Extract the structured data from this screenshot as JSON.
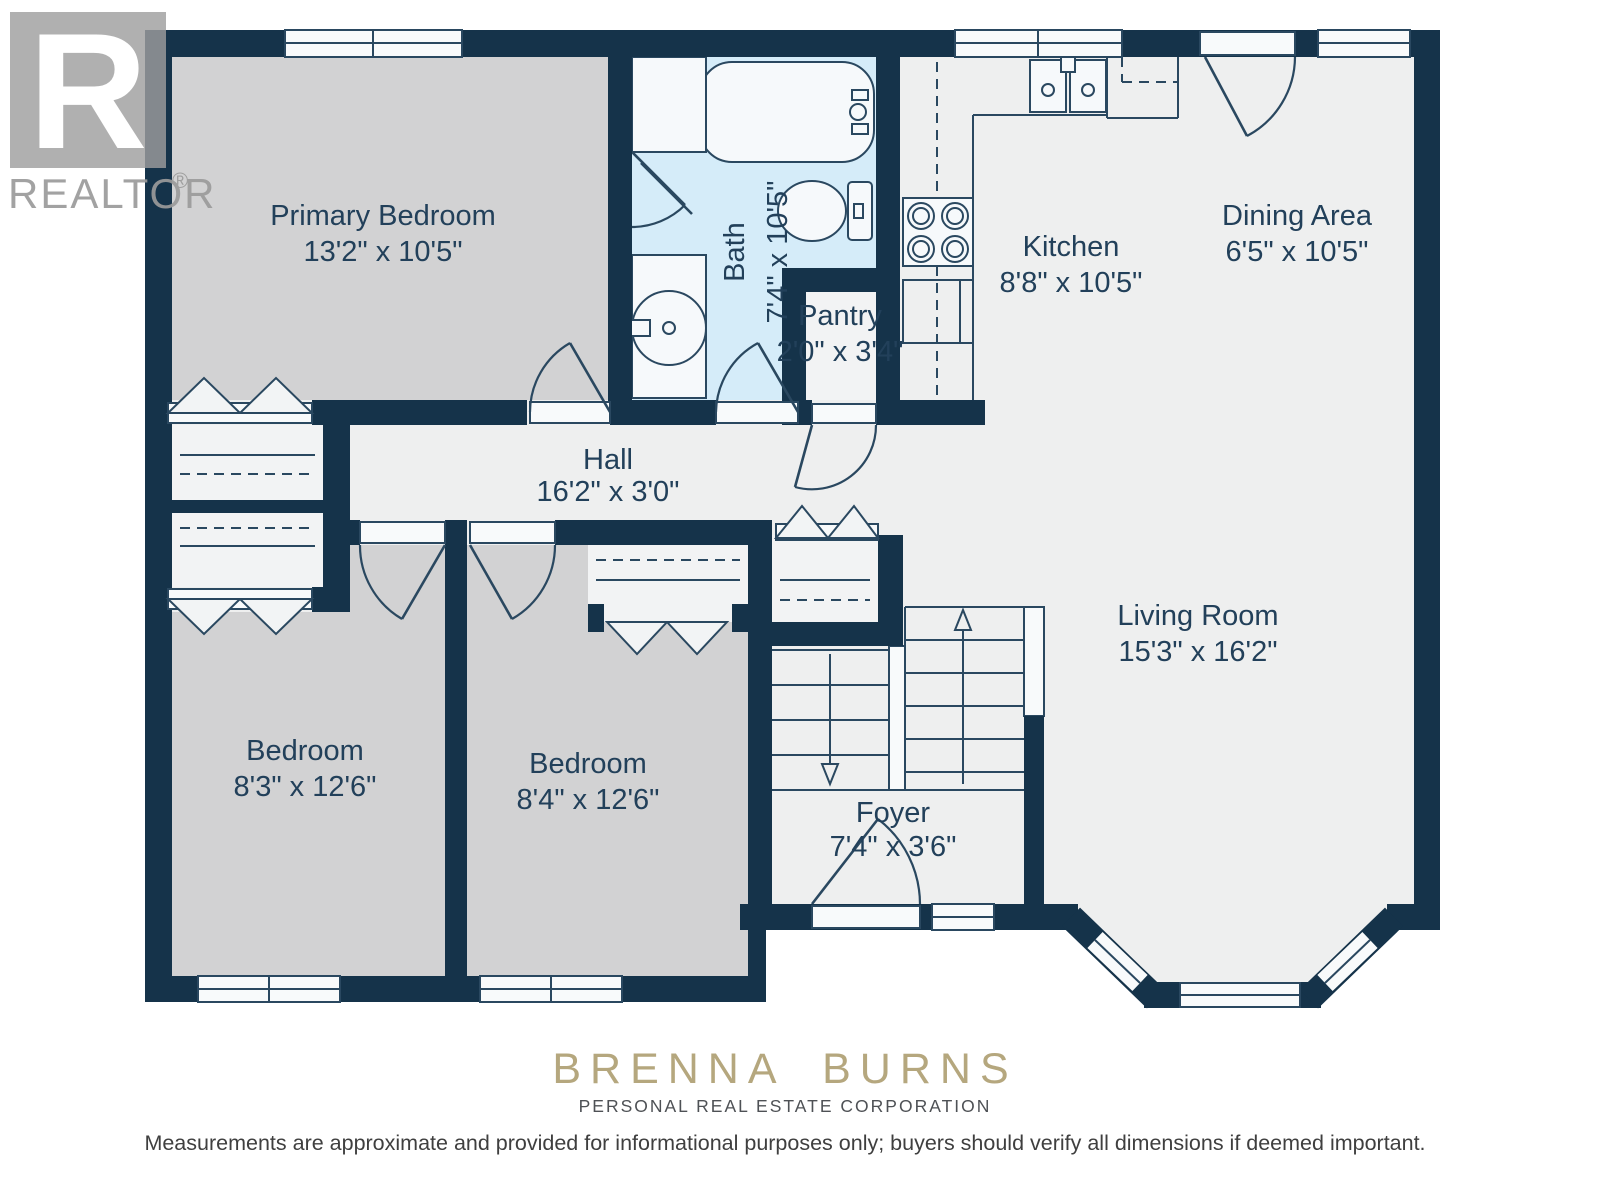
{
  "branding": {
    "realtor_r": "R",
    "realtor_wordmark": "REALTOR",
    "registered_mark": "®",
    "agent_name": "BRENNA BURNS",
    "agent_subtitle": "PERSONAL REAL ESTATE CORPORATION"
  },
  "disclaimer": "Measurements are approximate and provided for informational purposes only; buyers should verify all dimensions if deemed important.",
  "rooms": [
    {
      "name": "Primary Bedroom",
      "dims": "13'2\" x 10'5\""
    },
    {
      "name": "Bath",
      "dims": "7'4\" x 10'5\""
    },
    {
      "name": "Pantry",
      "dims": "2'0\" x 3'4\""
    },
    {
      "name": "Kitchen",
      "dims": "8'8\" x 10'5\""
    },
    {
      "name": "Dining Area",
      "dims": "6'5\" x 10'5\""
    },
    {
      "name": "Hall",
      "dims": "16'2\" x 3'0\""
    },
    {
      "name": "Bedroom",
      "dims": "8'3\" x 12'6\""
    },
    {
      "name": "Bedroom",
      "dims": "8'4\" x 12'6\""
    },
    {
      "name": "Foyer",
      "dims": "7'4\" x 3'6\""
    },
    {
      "name": "Living Room",
      "dims": "15'3\" x 16'2\""
    }
  ],
  "colors": {
    "wall_navy": "#15334A",
    "bath_blue": "#D5ECF9",
    "room_gray": "#D2D2D3",
    "floor_light": "#EEEFEF",
    "brand_gold": "#B5A77E",
    "label_navy": "#22405A"
  }
}
